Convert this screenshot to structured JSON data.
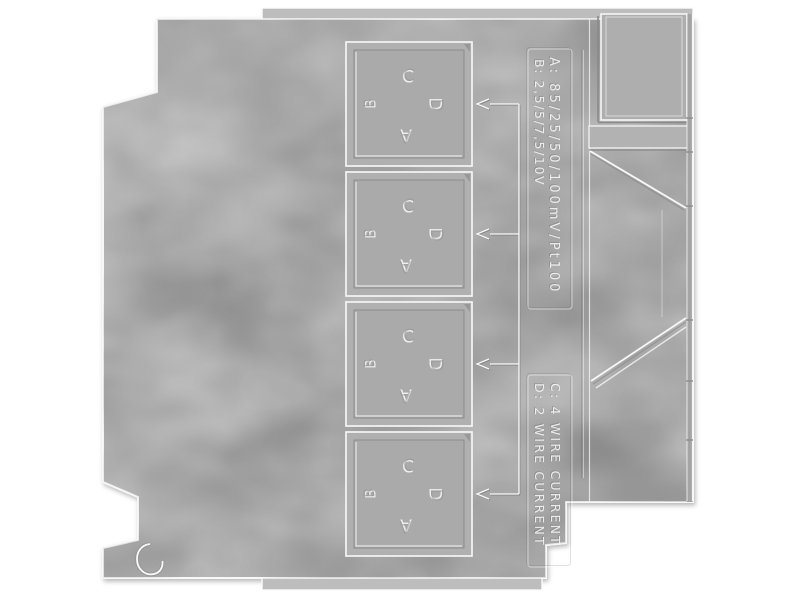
{
  "scene": {
    "description": "Grayscale rendered side panel of a DIN-rail mounted signal-converter housing",
    "background_color": "#ffffff"
  },
  "colors": {
    "panel_base": "#acacac",
    "panel_light": "#bdbdbd",
    "panel_dark": "#9c9c9c",
    "edge_highlight": "#f8f8f8",
    "seam_shadow": "#8a8a8a"
  },
  "switch_windows": {
    "count": 4,
    "letters": {
      "top": "C",
      "left": "B",
      "right": "D",
      "bottom": "A"
    }
  },
  "legend": {
    "input_ranges": [
      {
        "key": "A",
        "text": "A: 85/25/50/100mV/Pt100"
      },
      {
        "key": "B",
        "text": "B: 2,5/5/7,5/10V"
      }
    ],
    "wire_modes": [
      {
        "key": "C",
        "text": "C: 4 WIRE CURRENT"
      },
      {
        "key": "D",
        "text": "D: 2 WIRE CURRENT"
      }
    ]
  },
  "callouts": {
    "count": 4
  }
}
